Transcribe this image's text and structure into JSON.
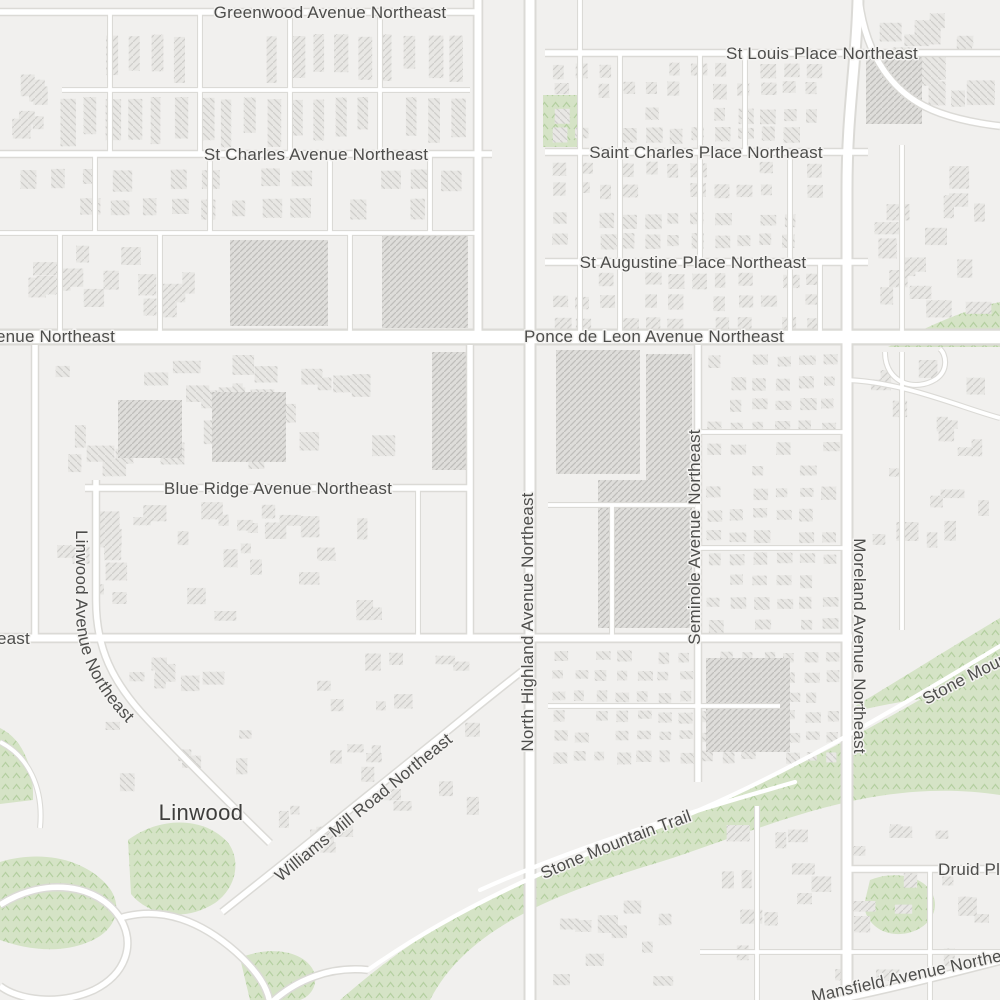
{
  "map": {
    "neighborhood_label": "Linwood",
    "street_labels": {
      "greenwood": "Greenwood Avenue Northeast",
      "st_louis": "St Louis Place Northeast",
      "st_charles_avenue": "St Charles Avenue Northeast",
      "saint_charles_place": "Saint Charles Place Northeast",
      "st_augustine": "St Augustine Place Northeast",
      "ponce_de_leon": "Ponce de Leon Avenue Northeast",
      "blue_ridge": "Blue Ridge Avenue Northeast",
      "linwood_avenue": "Linwood Avenue Northeast",
      "north_highland": "North Highland Avenue Northeast",
      "seminole": "Seminole Avenue Northeast",
      "moreland": "Moreland Avenue Northeast",
      "williams_mill": "Williams Mill Road Northeast",
      "mansfield": "Mansfield Avenue Northeast"
    },
    "trail_label": "Stone Mountain Trail",
    "partial_labels": {
      "avenue_left": "enue Northeast",
      "east_left": "east",
      "druid": "Druid Pl"
    },
    "colors": {
      "land": "#f1f0ee",
      "road_fill": "#ffffff",
      "road_casing": "#dbdad6",
      "park_green": "#d5e3c6",
      "park_texture": "#b4cfa0",
      "building_fill": "#e8e7e4",
      "building_hatch": "#cfcecb",
      "label_text": "#4d4d4b"
    }
  }
}
